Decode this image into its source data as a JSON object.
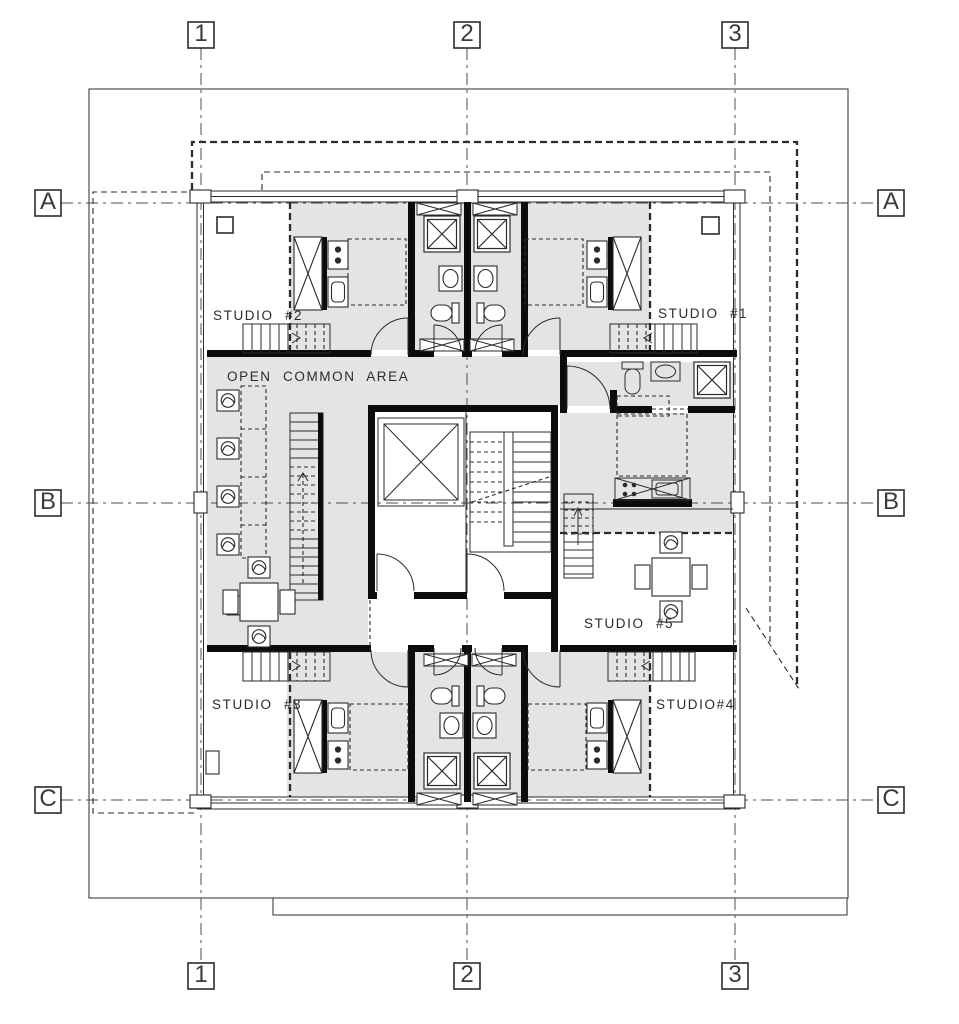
{
  "drawing": {
    "rooms": {
      "studio1": "STUDIO #1",
      "studio2": "STUDIO #2",
      "studio3": "STUDIO #3",
      "studio4": "STUDIO#4",
      "studio5": "STUDIO #5",
      "common_area": "OPEN COMMON AREA"
    },
    "grid": {
      "columns": [
        "1",
        "2",
        "3"
      ],
      "rows": [
        "A",
        "B",
        "C"
      ]
    },
    "colors": {
      "background": "#ffffff",
      "floor": "#e4e4e2",
      "line": "#2b2b2b",
      "wall": "#0c0c0c",
      "grid": "#4d4d4d"
    }
  }
}
